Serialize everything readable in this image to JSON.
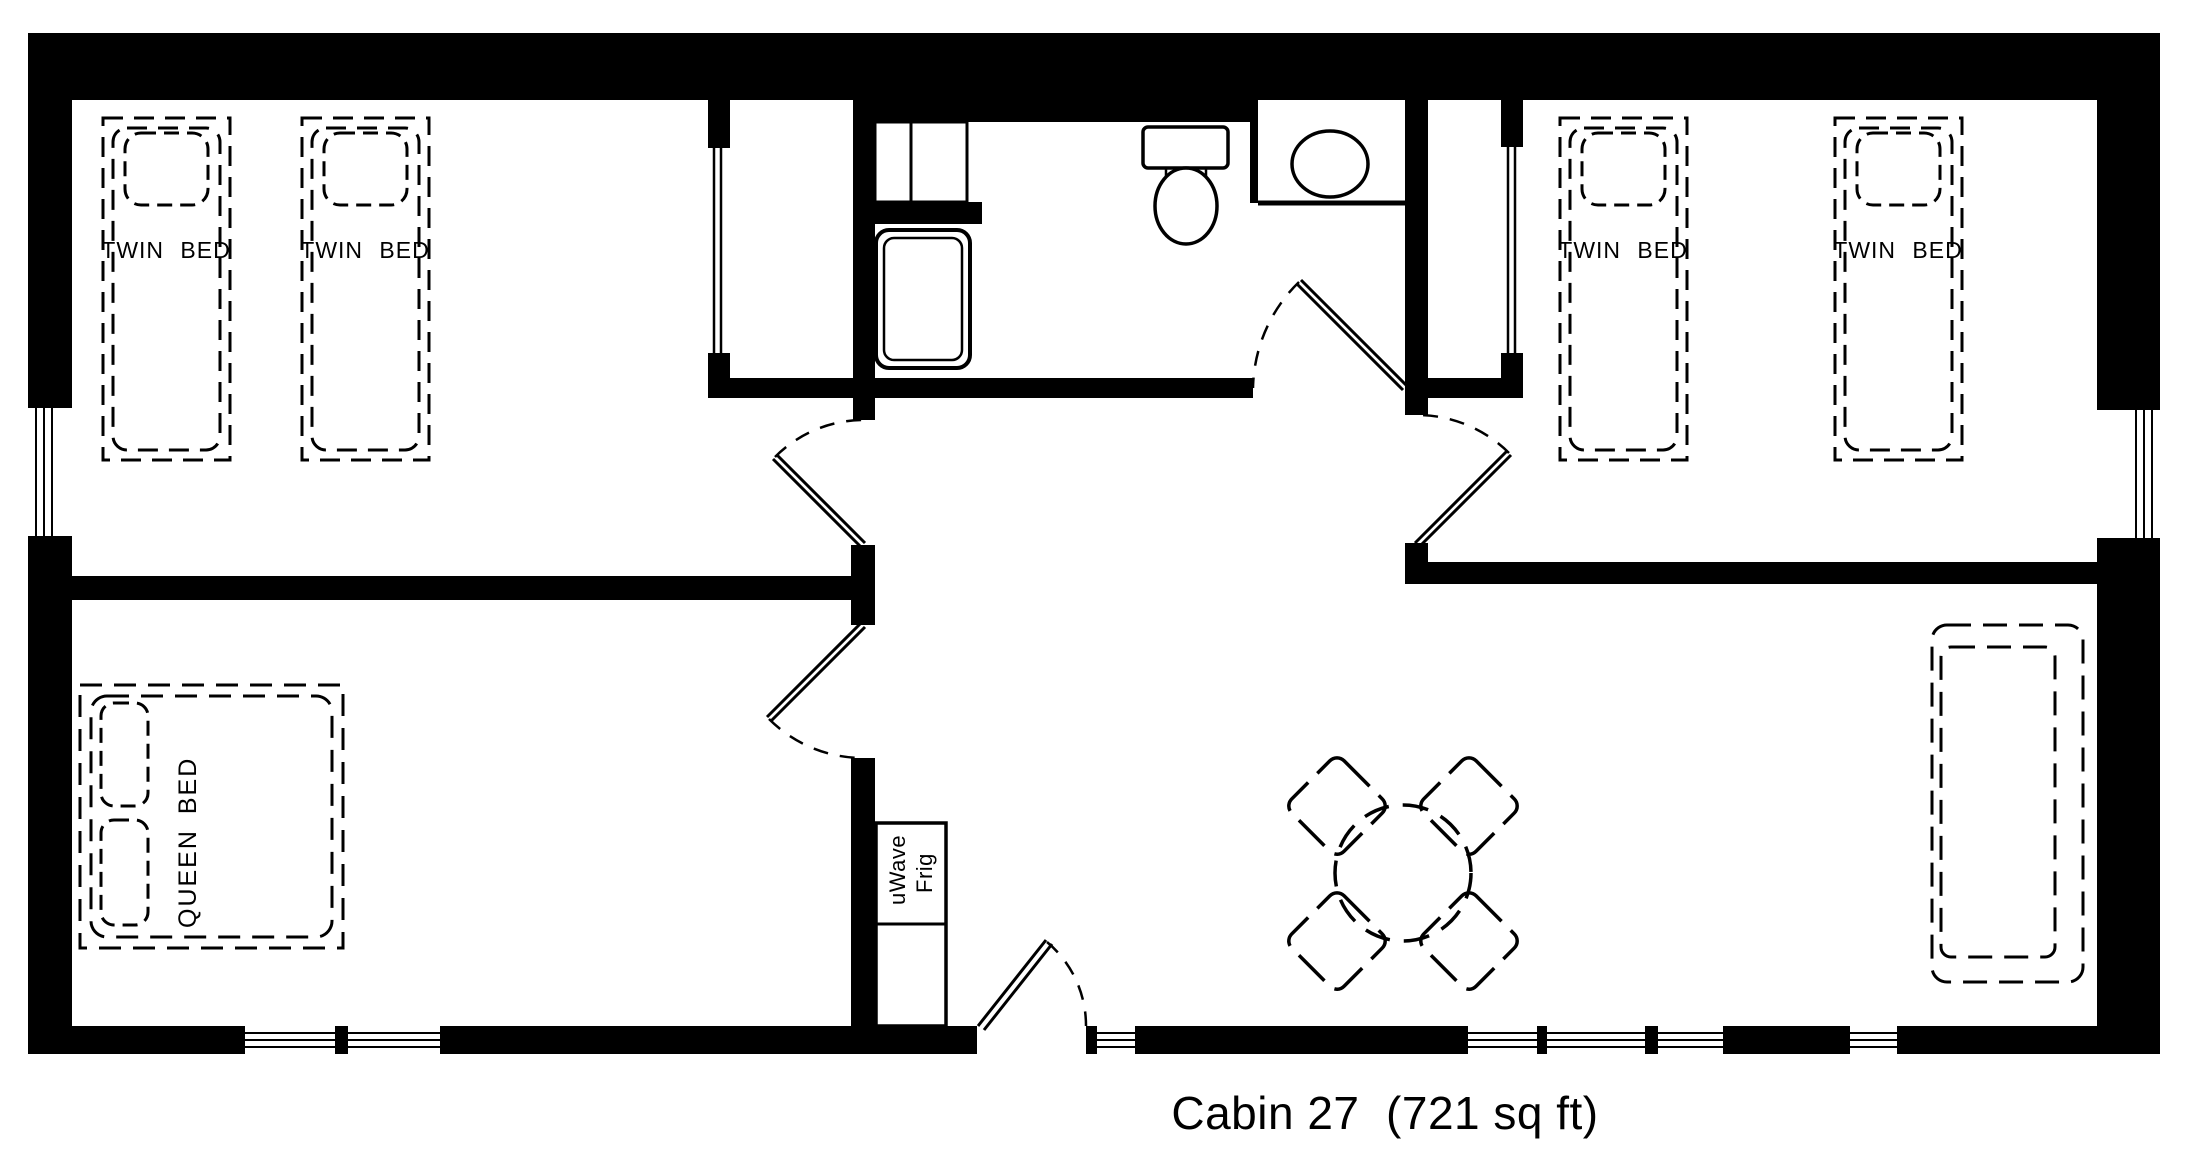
{
  "caption": "Cabin 27  (721 sq ft)",
  "labels": {
    "twin_bed": "TWIN BED",
    "queen_bed": "QUEEN BED",
    "microwave": "uWave",
    "fridge": "Frig"
  },
  "fixtures": {
    "bathroom": [
      "shower",
      "toilet",
      "sink-counter",
      "closet-shelves"
    ],
    "living": [
      "round-dining-table",
      "four-chairs",
      "couch"
    ],
    "kitchenette": [
      "microwave",
      "fridge"
    ]
  },
  "colors": {
    "ink": "#000000",
    "paper": "#ffffff"
  }
}
